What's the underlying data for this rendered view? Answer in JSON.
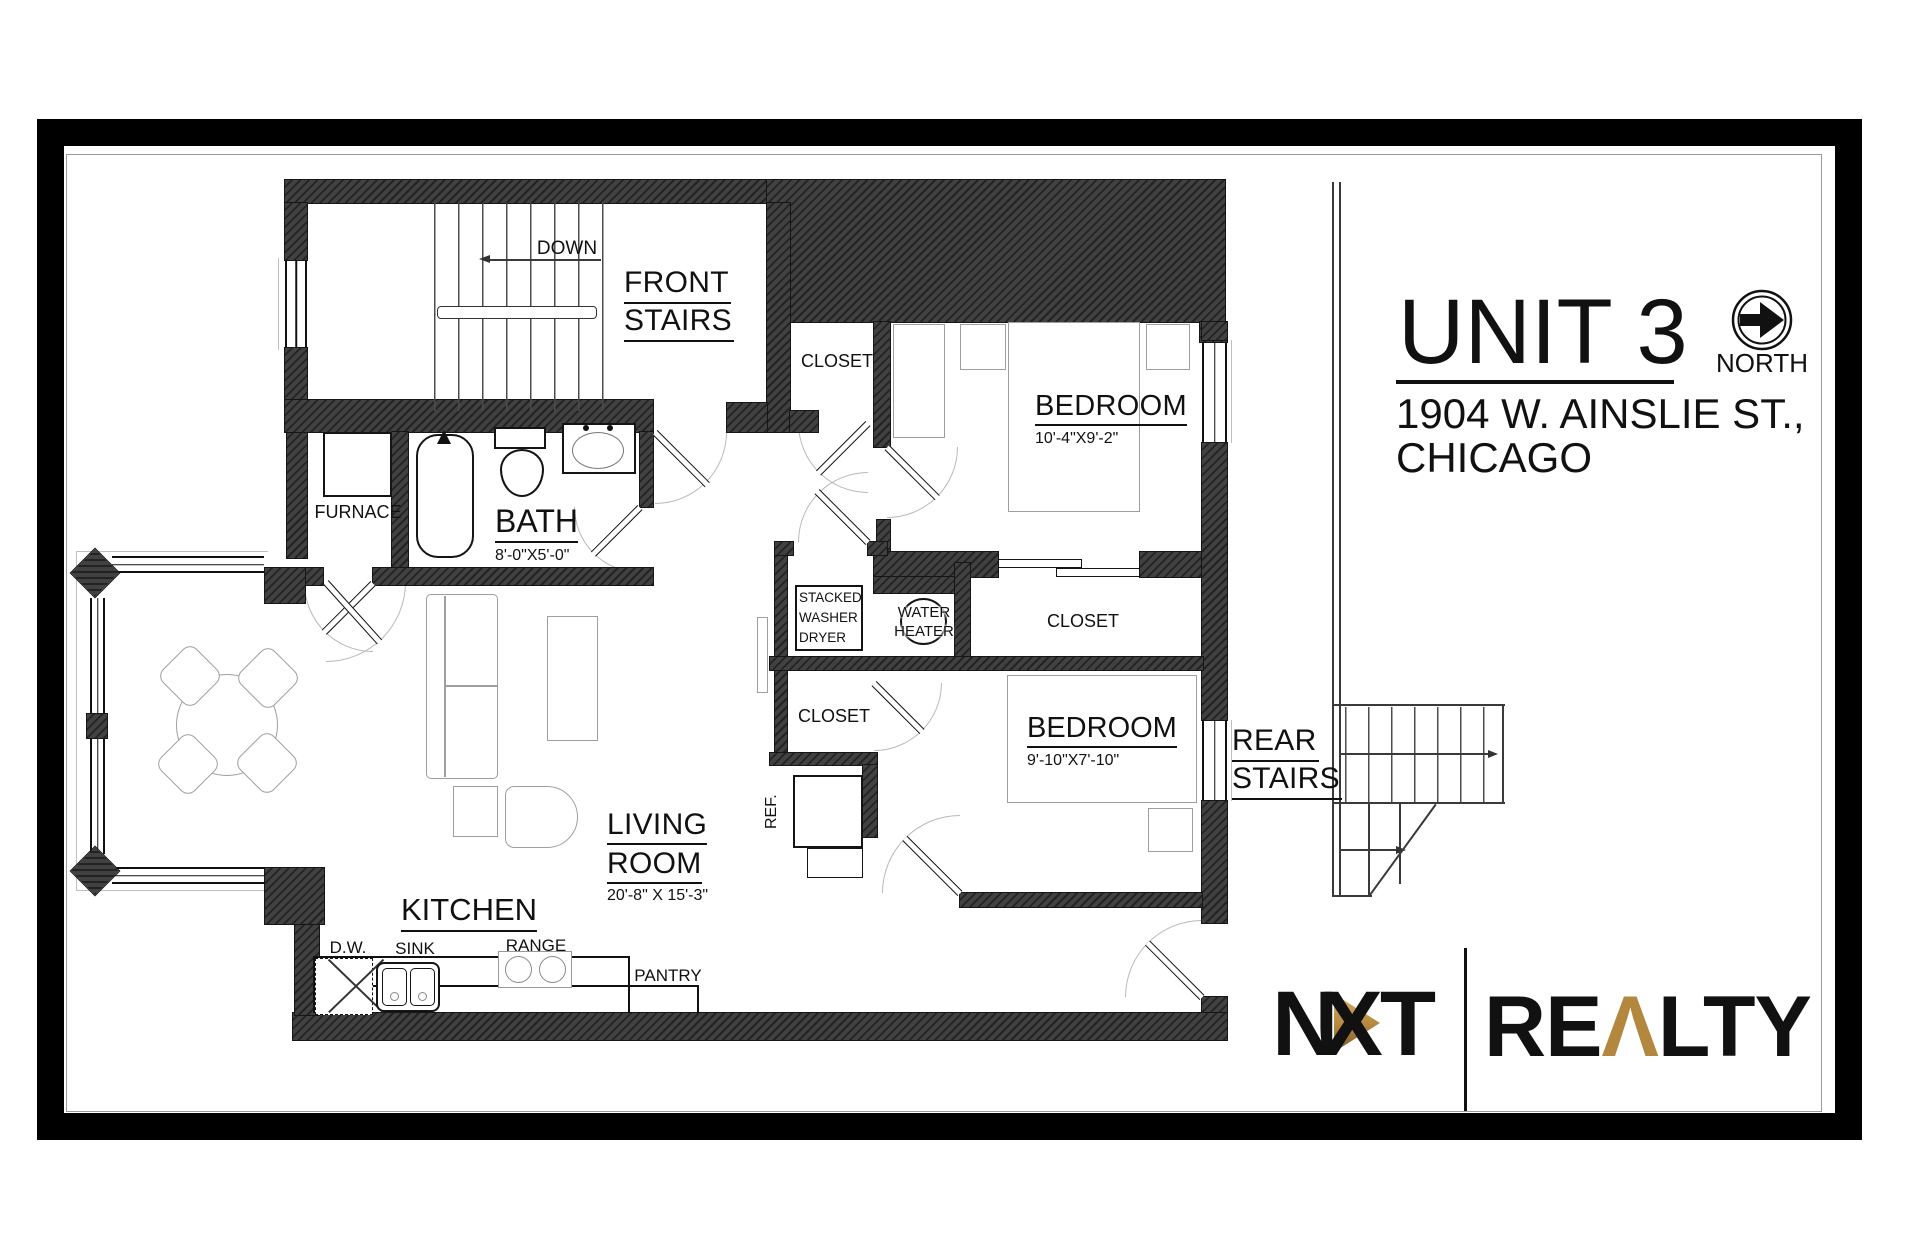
{
  "title_block": {
    "unit": "UNIT 3",
    "address_line_1": "1904 W. AINSLIE ST.,",
    "address_line_2": "CHICAGO",
    "north_label": "NORTH"
  },
  "logo": {
    "nxt_n": "N",
    "nxt_xt": "XT",
    "realty_pre": "RE",
    "realty_a": "Λ",
    "realty_post": "LTY"
  },
  "rooms": {
    "front_stairs_line1": "FRONT",
    "front_stairs_line2": "STAIRS",
    "down": "DOWN",
    "closet": "CLOSET",
    "bedroom_1": "BEDROOM",
    "bedroom_1_dim": "10'-4\"X9'-2\"",
    "bath": "BATH",
    "bath_dim": "8'-0\"X5'-0\"",
    "bedroom_2": "BEDROOM",
    "bedroom_2_dim": "9'-10\"X7'-10\"",
    "living_line1": "LIVING",
    "living_line2": "ROOM",
    "living_dim": "20'-8\" X 15'-3\"",
    "kitchen": "KITCHEN",
    "rear_stairs_line1": "REAR",
    "rear_stairs_line2": "STAIRS"
  },
  "fixtures": {
    "furnace": "FURNACE",
    "stacked_line1": "STACKED",
    "stacked_line2": "WASHER",
    "stacked_line3": "DRYER",
    "water_heater_line1": "WATER",
    "water_heater_line2": "HEATER",
    "refrigerator": "REF.",
    "dishwasher": "D.W.",
    "sink": "SINK",
    "range": "RANGE",
    "pantry": "PANTRY"
  },
  "colors": {
    "wall_dark": "#2f2f2f",
    "gold": "#b3873e",
    "line": "#111111"
  }
}
